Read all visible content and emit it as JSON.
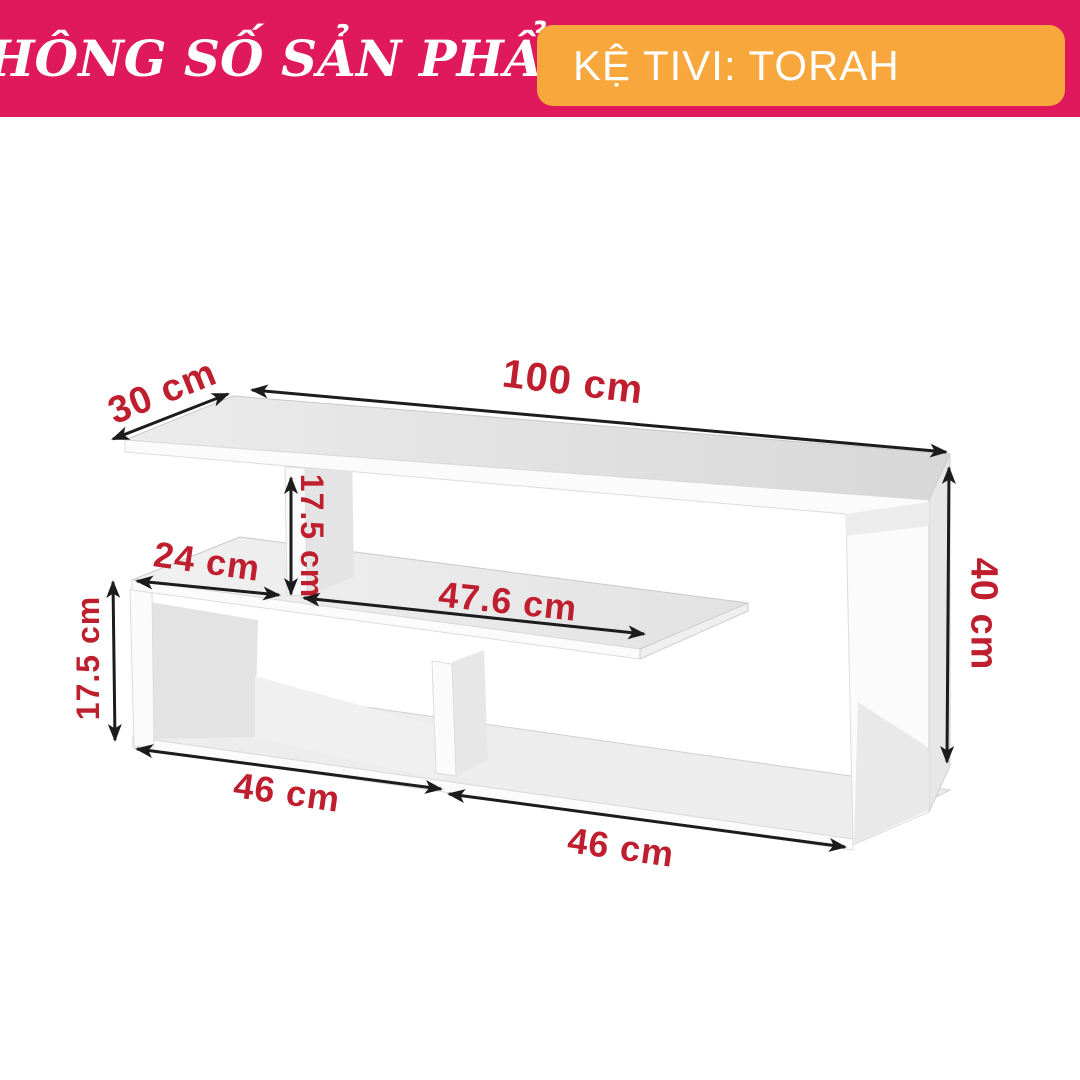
{
  "header": {
    "title": "THÔNG SỐ SẢN PHẨM",
    "product_label": "KỆ TIVI: TORAH",
    "banner_color": "#e0195c",
    "badge_color": "#f7a73c",
    "text_color": "#ffffff"
  },
  "diagram": {
    "product": "Kệ Tivi TORAH",
    "unit": "cm",
    "dimension_label_color": "#bf1e2e",
    "arrow_color": "#1c1c1c",
    "dimensions": [
      {
        "name": "top-panel-depth",
        "value": 30,
        "label": "30 cm"
      },
      {
        "name": "top-panel-width",
        "value": 100,
        "label": "100 cm"
      },
      {
        "name": "upper-divider-height",
        "value": 17.5,
        "label": "17.5 cm"
      },
      {
        "name": "left-shelf-top-width",
        "value": 24,
        "label": "24 cm"
      },
      {
        "name": "middle-shelf-length",
        "value": 47.6,
        "label": "47.6 cm"
      },
      {
        "name": "overall-height",
        "value": 40,
        "label": "40 cm"
      },
      {
        "name": "left-opening-height",
        "value": 17.5,
        "label": "17.5 cm"
      },
      {
        "name": "left-compartment-width",
        "value": 46,
        "label": "46 cm"
      },
      {
        "name": "right-compartment-width",
        "value": 46,
        "label": "46 cm"
      }
    ]
  }
}
